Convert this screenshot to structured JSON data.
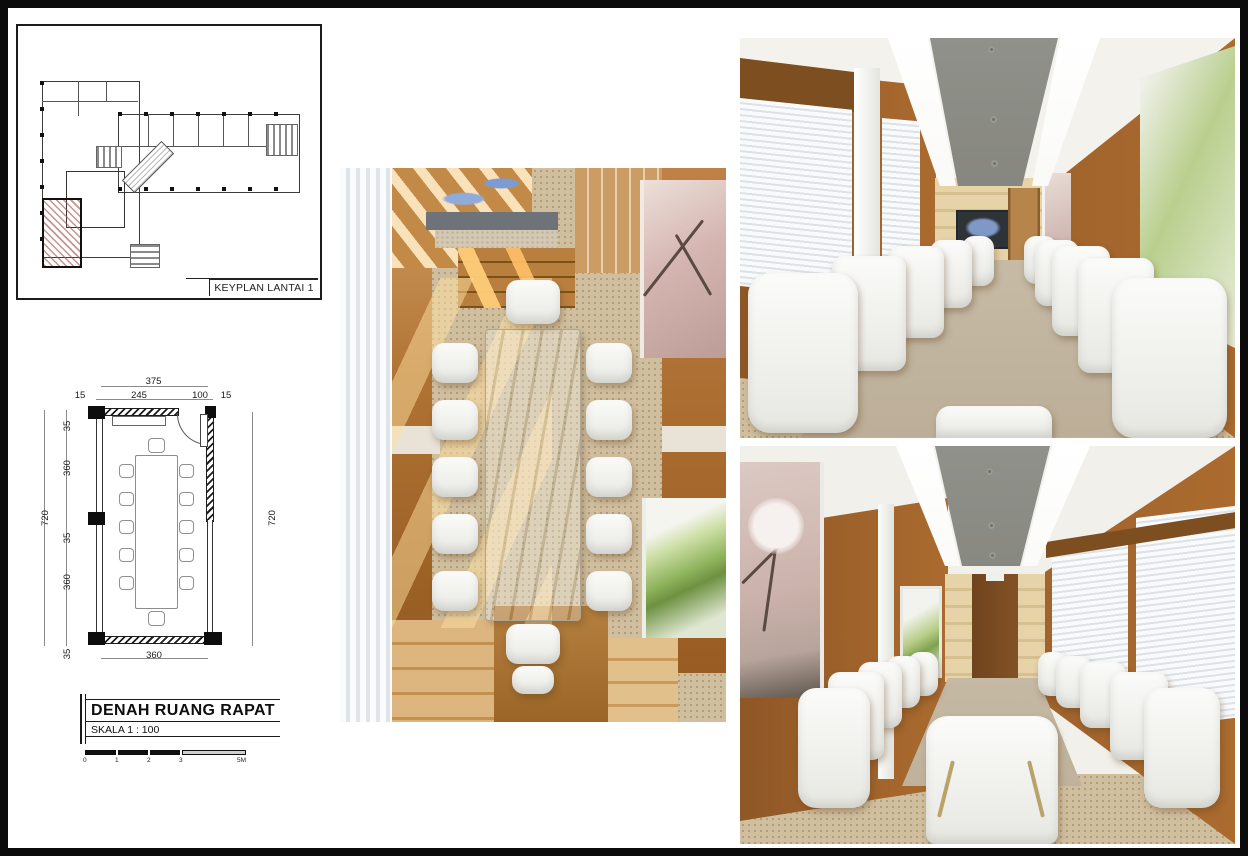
{
  "keyplan": {
    "label": "KEYPLAN LANTAI 1"
  },
  "plan": {
    "title": "DENAH RUANG RAPAT",
    "scale": "SKALA 1 : 100",
    "dims_top": {
      "overall": "375",
      "segments": [
        "15",
        "245",
        "100",
        "15"
      ]
    },
    "dims_left": {
      "overall": "720",
      "segments": [
        "35",
        "360",
        "35",
        "360",
        "35"
      ]
    },
    "dims_right": {
      "overall": "720"
    },
    "dims_bottom": {
      "overall": "360"
    },
    "scale_bar_ticks": [
      "0",
      "1",
      "2",
      "3",
      "5M"
    ]
  },
  "colors": {
    "wood_wall": "#a96a2e",
    "light_wood": "#e0cba0",
    "ceiling_gray": "#8c8c84",
    "carpet": "#d0bf9f",
    "marble_table": "#c9c0b1",
    "blinds": "#eef1f3",
    "artwork_green": "#8fb45e",
    "artwork_pink": "#d5b5b0",
    "plan_hatch_red": "#a8584e"
  }
}
